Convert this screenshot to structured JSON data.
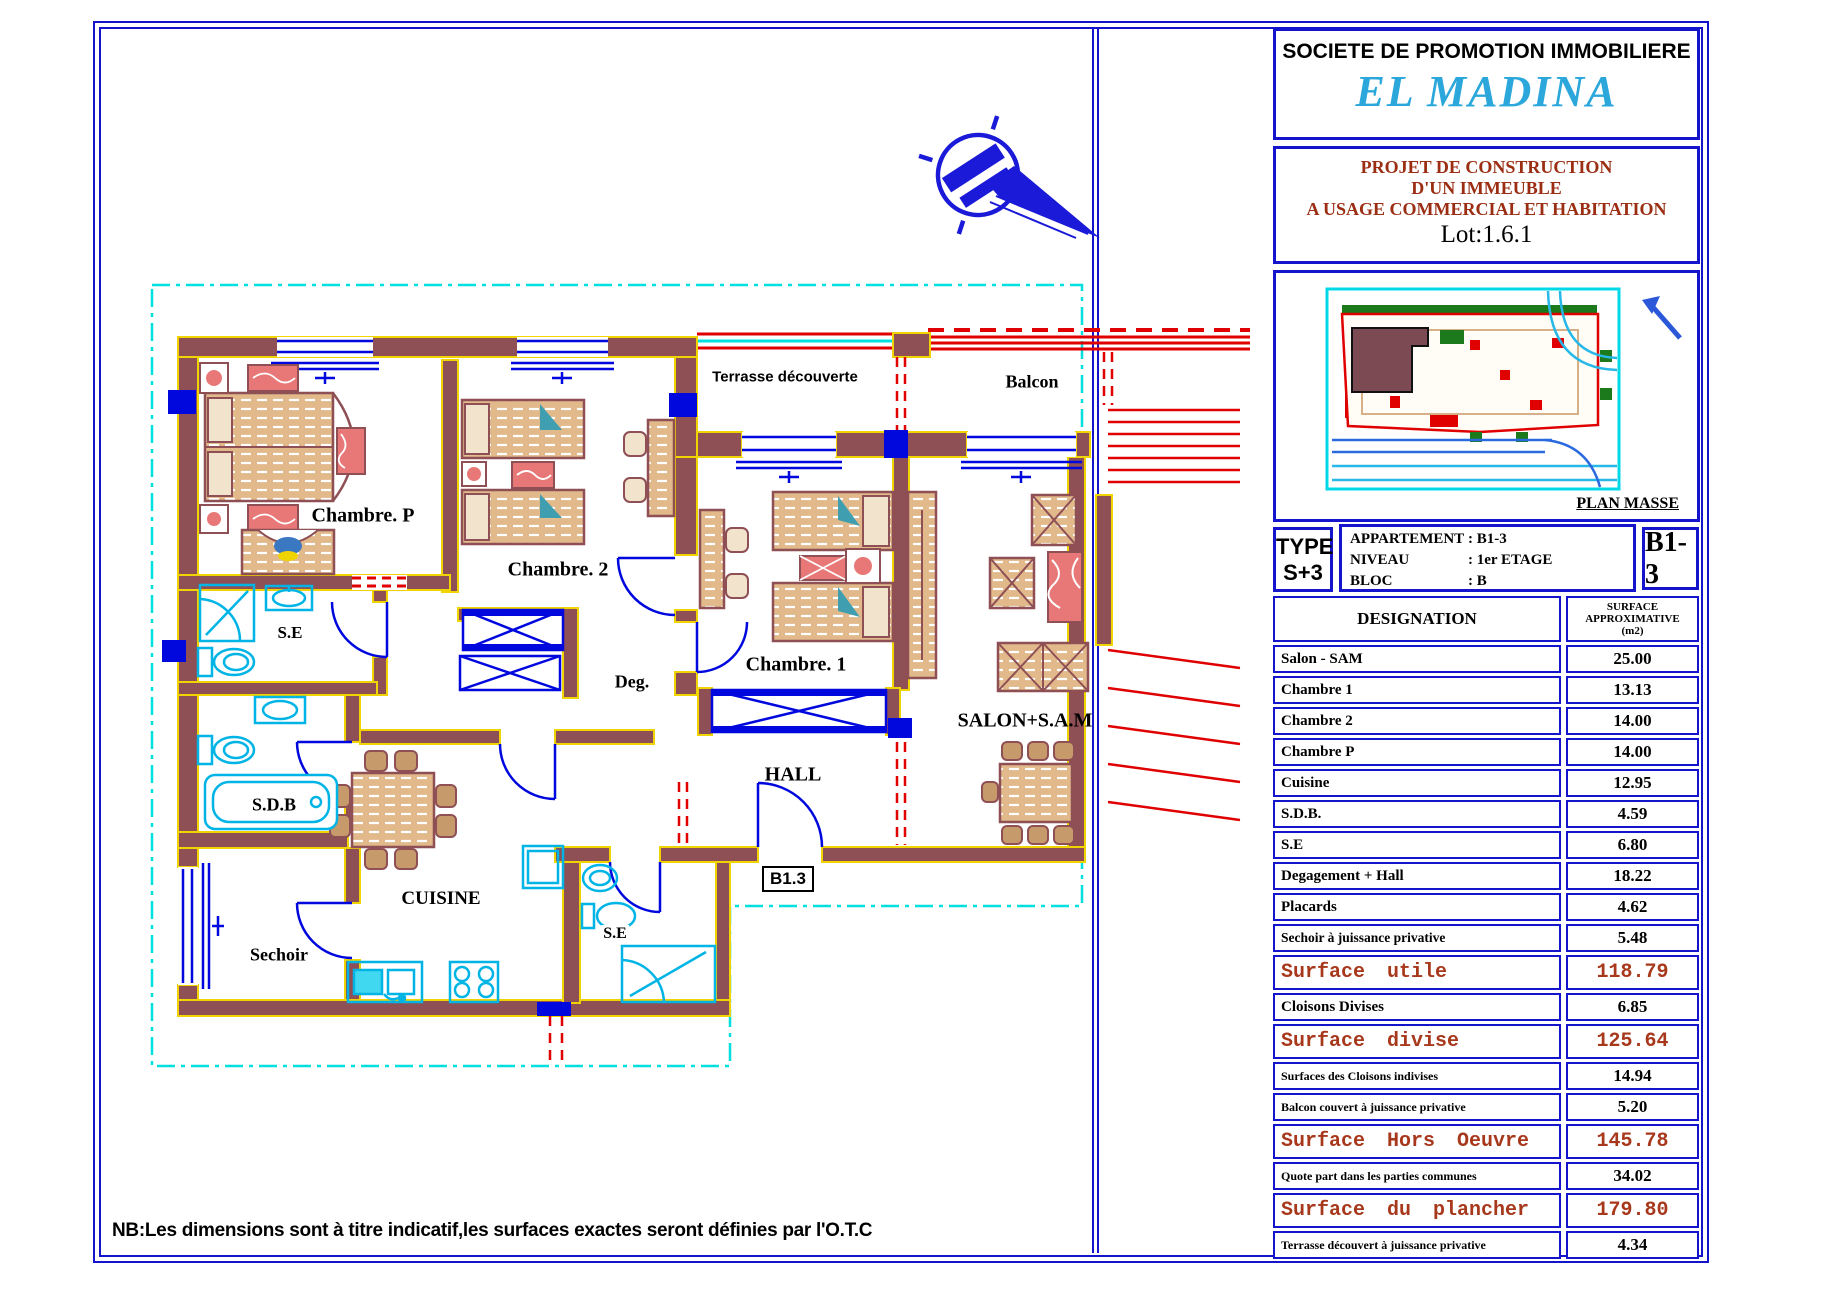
{
  "title_block": {
    "company": "SOCIETE DE PROMOTION IMMOBILIERE",
    "brand": "EL MADINA",
    "project_line1": "PROJET DE CONSTRUCTION",
    "project_line2": "D'UN IMMEUBLE",
    "project_line3": "A USAGE COMMERCIAL ET HABITATION",
    "lot": "Lot:1.6.1",
    "plan_masse_label": "PLAN MASSE",
    "type_label": "TYPE",
    "type_value": "S+3",
    "info": [
      {
        "label": "APPARTEMENT",
        "value": ": B1-3"
      },
      {
        "label": "NIVEAU",
        "value": ": 1er ETAGE"
      },
      {
        "label": "BLOC",
        "value": ": B"
      }
    ],
    "unit_code": "B1-3"
  },
  "table": {
    "header_col1": "DESIGNATION",
    "header_col2_line1": "SURFACE",
    "header_col2_line2": "APPROXIMATIVE",
    "header_col2_line3": "(m2)",
    "rows": [
      {
        "label": "Salon - SAM",
        "value": "25.00",
        "summary": false
      },
      {
        "label": "Chambre 1",
        "value": "13.13",
        "summary": false
      },
      {
        "label": "Chambre 2",
        "value": "14.00",
        "summary": false
      },
      {
        "label": "Chambre P",
        "value": "14.00",
        "summary": false
      },
      {
        "label": "Cuisine",
        "value": "12.95",
        "summary": false
      },
      {
        "label": "S.D.B.",
        "value": "4.59",
        "summary": false
      },
      {
        "label": "S.E",
        "value": "6.80",
        "summary": false
      },
      {
        "label": "Degagement + Hall",
        "value": "18.22",
        "summary": false
      },
      {
        "label": "Placards",
        "value": "4.62",
        "summary": false
      },
      {
        "label": "Sechoir à juissance privative",
        "value": "5.48",
        "summary": false
      },
      {
        "label": "Surface utile",
        "value": "118.79",
        "summary": true
      },
      {
        "label": "Cloisons Divises",
        "value": "6.85",
        "summary": false
      },
      {
        "label": "Surface divise",
        "value": "125.64",
        "summary": true
      },
      {
        "label": "Surfaces des Cloisons indivises",
        "value": "14.94",
        "summary": false
      },
      {
        "label": "Balcon couvert à juissance privative",
        "value": "5.20",
        "summary": false
      },
      {
        "label": "Surface Hors Oeuvre",
        "value": "145.78",
        "summary": true
      },
      {
        "label": "Quote part dans les parties communes",
        "value": "34.02",
        "summary": false
      },
      {
        "label": "Surface du plancher",
        "value": "179.80",
        "summary": true
      },
      {
        "label": "Terrasse découvert à juissance privative",
        "value": "4.34",
        "summary": false
      }
    ]
  },
  "floorplan": {
    "rooms": {
      "terrasse": "Terrasse découverte",
      "balcon": "Balcon",
      "chambre_p": "Chambre. P",
      "chambre_2": "Chambre. 2",
      "chambre_1": "Chambre. 1",
      "se_upper": "S.E",
      "deg": "Deg.",
      "salon": "SALON+S.A.M",
      "hall": "HALL",
      "sdb": "S.D.B",
      "cuisine": "CUISINE",
      "sechoir": "Sechoir",
      "se_lower": "S.E",
      "unit_tag": "B1.3"
    },
    "note": "NB:Les dimensions sont à titre indicatif,les surfaces exactes seront définies par l'O.T.C"
  },
  "colors": {
    "border_blue": "#1414cc",
    "plan_blue": "#0008dd",
    "brand_cyan": "#2ba7db",
    "heading_red": "#9a2d12",
    "summary_red": "#a8381c",
    "wall_maroon": "#8e4f55",
    "accent_yellow": "#f0d400",
    "boundary_cyan": "#00e0e0",
    "fixture_cyan": "#00b4e6",
    "red": "#e00000",
    "furniture_tan": "#e2b98a",
    "green": "#1c7a1c"
  }
}
